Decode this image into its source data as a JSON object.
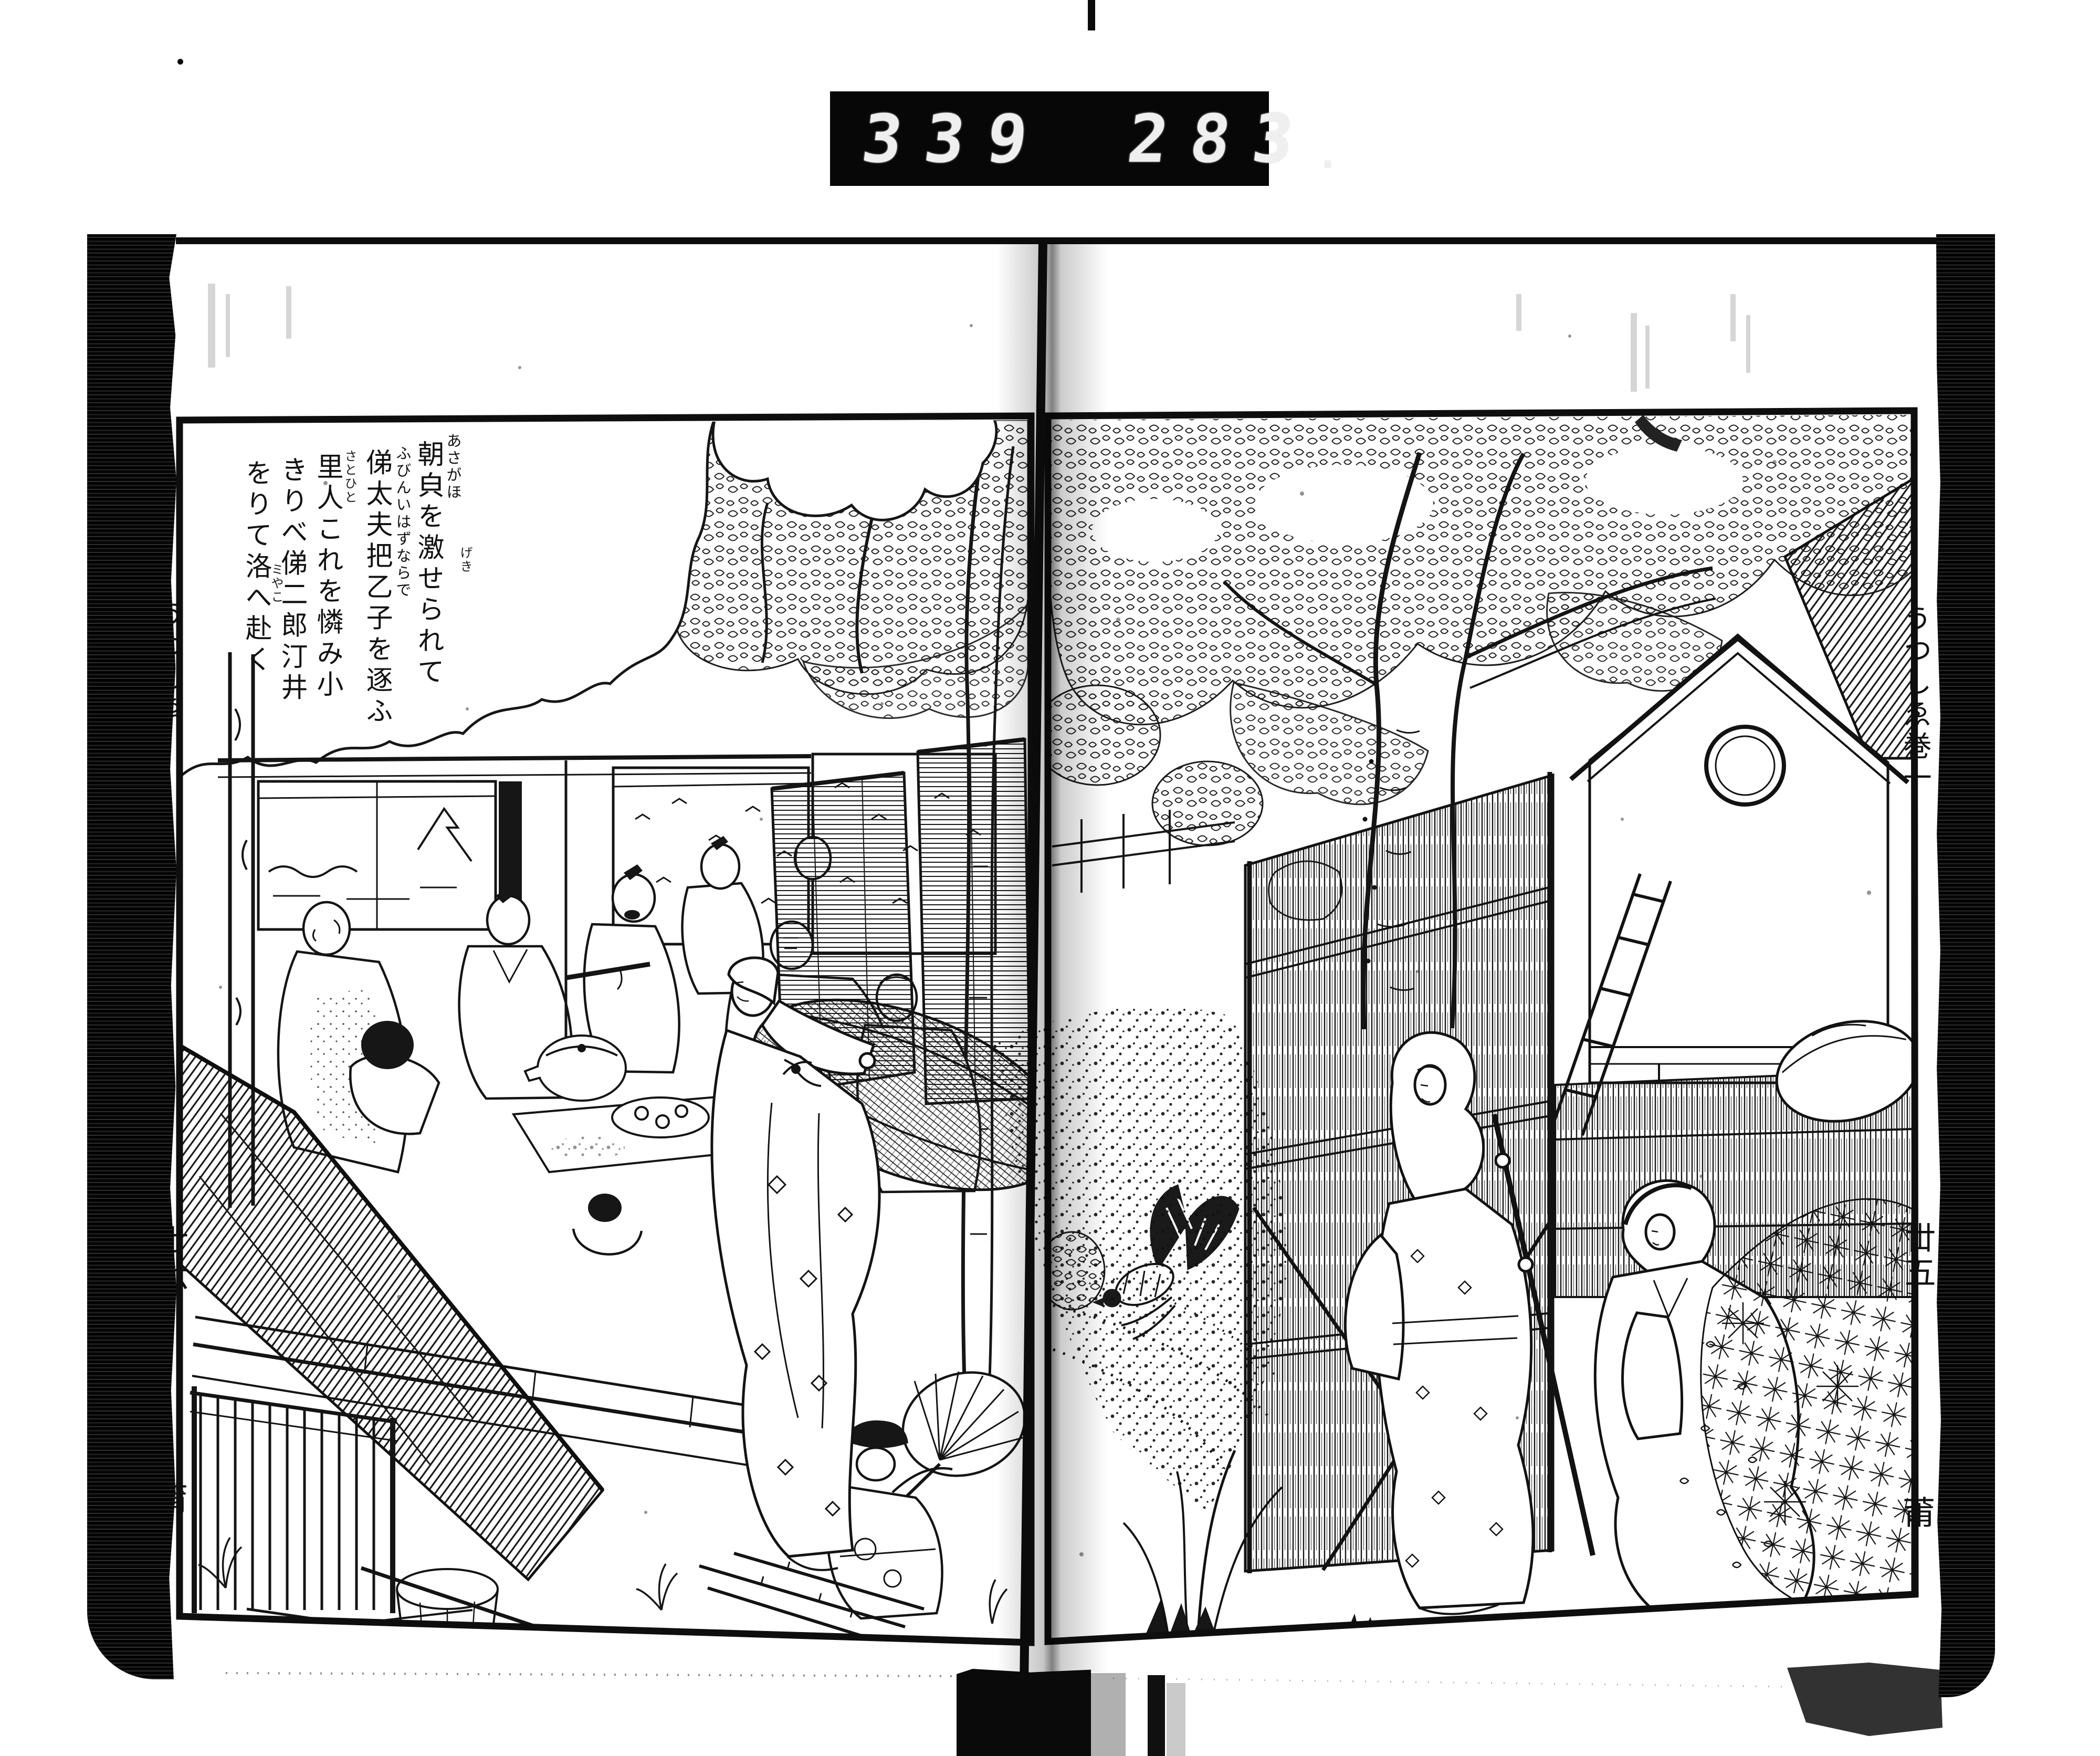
{
  "counter": {
    "left_value": "339",
    "right_value": "283",
    "decimal_point": "."
  },
  "left_page": {
    "cartouche_columns": [
      {
        "text": "あさがほ"
      },
      {
        "text": "朝㒵を激せられて"
      },
      {
        "text": "げき"
      },
      {
        "text": "ふびんいはずならで"
      },
      {
        "text": "俤太夫把乙子を逐ふ"
      },
      {
        "text": "さとひと"
      },
      {
        "text": "里人これを憐み小"
      },
      {
        "text": "きりべ俤二郎汀井"
      },
      {
        "text": "をりて洛へ赴く"
      },
      {
        "text": "ミやこ"
      }
    ],
    "pillar_title": "うつしゑ",
    "folio_number": "丗六",
    "collation_mark": "莆"
  },
  "right_page": {
    "pillar_title": "うつしゑ巻一",
    "folio_number": "丗五",
    "collation_mark": "莆"
  },
  "colors": {
    "ink": "#121212",
    "paper": "#ffffff",
    "counter_bg": "#070707",
    "counter_digits": "#efefef"
  }
}
